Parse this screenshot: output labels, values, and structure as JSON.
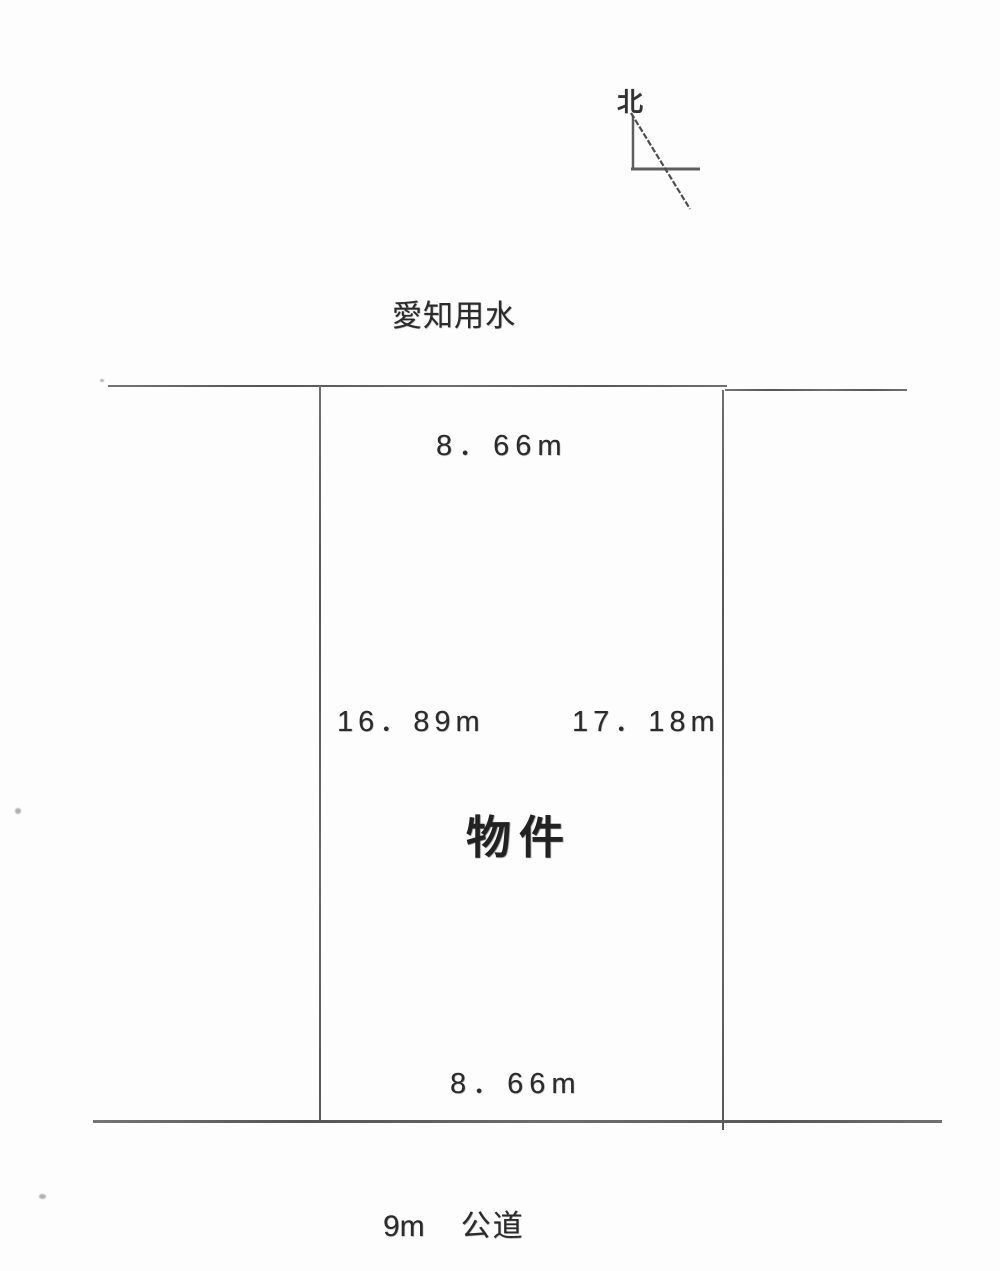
{
  "document": {
    "type": "land-plot-survey-diagram",
    "background_color": "#fdfdfd",
    "line_color": "#646464",
    "text_color": "#2b2b2b"
  },
  "north_indicator": {
    "label": "北"
  },
  "labels": {
    "waterway": "愛知用水",
    "property": "物件",
    "road_width": "9m",
    "road_type": "公道"
  },
  "dimensions": {
    "top": "8．66m",
    "left": "16．89m",
    "right": "17．18m",
    "bottom": "8．66m"
  }
}
